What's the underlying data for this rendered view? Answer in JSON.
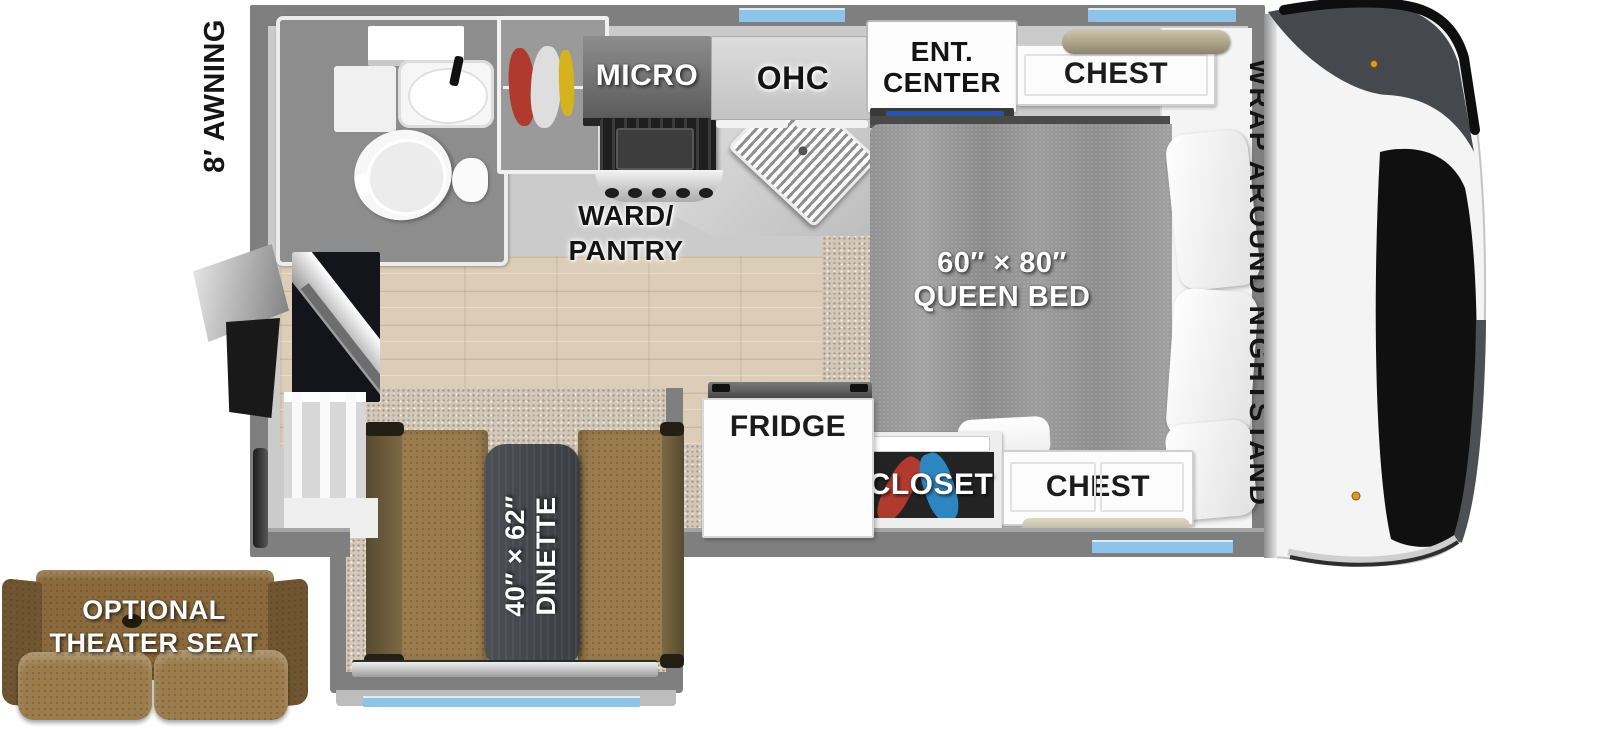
{
  "title": "Truck camper floor plan",
  "colors": {
    "wall": "#7f7f7f",
    "window": "#8ec4ea",
    "wood": "#dbcdb8",
    "carpet": "#d2c8ba",
    "bench": "#9a7c4e",
    "bench_back": "#6d5a39",
    "table": "#44474c",
    "couch": "#8a6a3d",
    "bed": "#979797",
    "tv": "#2a50b8",
    "closet_red": "#b03a2e",
    "closet_blue": "#2e86c1",
    "wardrobe_yellow": "#d4b31e",
    "shelf_tan": "#b3a88c"
  },
  "exterior": {
    "awning_label": "8′ AWNING"
  },
  "kitchen": {
    "micro_label": "MICRO",
    "ohc_label": "OHC",
    "ward_line1": "WARD/",
    "ward_line2": "PANTRY",
    "fridge_label": "FRIDGE"
  },
  "bedroom": {
    "ent_line1": "ENT.",
    "ent_line2": "CENTER",
    "chest_top_label": "CHEST",
    "chest_bottom_label": "CHEST",
    "closet_label": "CLOSET",
    "nightstand_label": "WRAP AROUND NIGHTSTAND",
    "bed_line1": "60″ × 80″",
    "bed_line2": "QUEEN BED"
  },
  "dinette": {
    "line1": "40″ × 62″",
    "line2": "DINETTE"
  },
  "theater": {
    "line1": "OPTIONAL",
    "line2": "THEATER SEAT"
  }
}
